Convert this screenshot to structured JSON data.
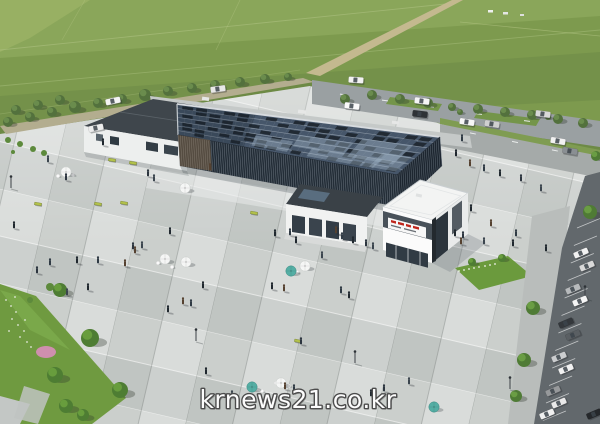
{
  "watermark": {
    "text": "krnews21.co.kr",
    "color": "#fcfcfc",
    "outline": "#4c4c4c"
  },
  "palette": {
    "field": "#7d9a4e",
    "fieldLight": "#8aa65a",
    "plaza": "#ced2d0",
    "plazaLight": "#d9dcda",
    "roofGlass": "#46566a",
    "roofPanelDark": "#1d242c",
    "roofReflection": "#a3b7c8",
    "latticeDark": "#232d37",
    "latticeLine": "#8e99a3",
    "buildingWhite": "#f1f2f1",
    "roadAsphalt": "#9aa0a2",
    "parkingAsphalt": "#62686c",
    "gardenGreen": "#6f9a40",
    "umbrellaTeal": "#54aea4",
    "umbrellaWhite": "#f5f6f5",
    "signRed": "#c0271d",
    "dirtRoad": "#c4b98f",
    "flowerPink": "#cf8fae",
    "lawnLetterWhite": "#f2f4ef",
    "person_colors": [
      "#2c353f",
      "#3b454e",
      "#1f272e",
      "#554130",
      "#2f3a44",
      "#20282f"
    ]
  },
  "figures": {
    "people": [
      [
        66,
        180
      ],
      [
        48,
        162
      ],
      [
        14,
        228
      ],
      [
        125,
        266
      ],
      [
        98,
        263
      ],
      [
        170,
        234
      ],
      [
        133,
        249
      ],
      [
        142,
        248
      ],
      [
        203,
        288
      ],
      [
        183,
        304
      ],
      [
        191,
        306
      ],
      [
        275,
        236
      ],
      [
        338,
        234
      ],
      [
        322,
        258
      ],
      [
        272,
        289
      ],
      [
        284,
        291
      ],
      [
        341,
        293
      ],
      [
        349,
        298
      ],
      [
        301,
        344
      ],
      [
        232,
        397
      ],
      [
        206,
        374
      ],
      [
        285,
        389
      ],
      [
        294,
        391
      ],
      [
        371,
        396
      ],
      [
        384,
        391
      ],
      [
        409,
        384
      ],
      [
        456,
        156
      ],
      [
        470,
        166
      ],
      [
        484,
        171
      ],
      [
        500,
        176
      ],
      [
        521,
        181
      ],
      [
        541,
        191
      ],
      [
        471,
        211
      ],
      [
        491,
        226
      ],
      [
        516,
        236
      ],
      [
        546,
        251
      ],
      [
        463,
        238
      ],
      [
        484,
        244
      ],
      [
        513,
        246
      ],
      [
        336,
        233
      ],
      [
        342,
        239
      ],
      [
        353,
        243
      ],
      [
        366,
        246
      ],
      [
        373,
        249
      ],
      [
        455,
        236
      ],
      [
        461,
        244
      ],
      [
        290,
        235
      ],
      [
        296,
        243
      ],
      [
        148,
        176
      ],
      [
        154,
        181
      ],
      [
        103,
        145
      ],
      [
        210,
        170
      ],
      [
        50,
        265
      ],
      [
        77,
        263
      ],
      [
        37,
        273
      ],
      [
        67,
        295
      ],
      [
        88,
        290
      ],
      [
        135,
        253
      ],
      [
        462,
        141
      ],
      [
        168,
        312
      ]
    ],
    "umbrellas": [
      [
        66,
        172,
        "w"
      ],
      [
        185,
        188,
        "w"
      ],
      [
        165,
        259,
        "w"
      ],
      [
        186,
        262,
        "w"
      ],
      [
        305,
        266,
        "w"
      ],
      [
        291,
        271,
        "t"
      ],
      [
        281,
        383,
        "w"
      ],
      [
        252,
        387,
        "t"
      ],
      [
        434,
        407,
        "t"
      ]
    ],
    "tables": [
      [
        58,
        176
      ],
      [
        73,
        175
      ],
      [
        158,
        263
      ],
      [
        172,
        267
      ],
      [
        297,
        272
      ],
      [
        276,
        383
      ],
      [
        289,
        386
      ],
      [
        262,
        391
      ]
    ],
    "benches": [
      [
        38,
        204,
        10
      ],
      [
        98,
        204,
        10
      ],
      [
        124,
        203,
        10
      ],
      [
        112,
        160,
        9
      ],
      [
        133,
        163,
        9
      ],
      [
        254,
        213,
        10
      ],
      [
        298,
        341,
        12
      ]
    ],
    "lamps": [
      [
        11,
        188
      ],
      [
        196,
        341
      ],
      [
        355,
        363
      ],
      [
        510,
        389
      ],
      [
        585,
        298
      ]
    ],
    "cars": [
      [
        113,
        101,
        -12,
        "#f4f4f4"
      ],
      [
        96,
        128,
        -12,
        "#ececec"
      ],
      [
        218,
        89,
        -8,
        "#e8e8e8"
      ],
      [
        356,
        80,
        4,
        "#f2f2f2"
      ],
      [
        352,
        106,
        7,
        "#fafafa"
      ],
      [
        422,
        101,
        7,
        "#f5f5f5"
      ],
      [
        420,
        114,
        7,
        "#2e3236"
      ],
      [
        543,
        114,
        8,
        "#d8d8d8"
      ],
      [
        467,
        122,
        9,
        "#f6f6f6"
      ],
      [
        492,
        124,
        9,
        "#cfcfcf"
      ],
      [
        558,
        141,
        10,
        "#f1f1f1"
      ],
      [
        570,
        151,
        10,
        "#8a8f93"
      ],
      [
        581,
        253,
        -23,
        "#f2f2f2"
      ],
      [
        587,
        266,
        -23,
        "#d9d9d9"
      ],
      [
        573,
        289,
        -23,
        "#b7babc"
      ],
      [
        580,
        301,
        -23,
        "#f5f5f5"
      ],
      [
        566,
        323,
        -23,
        "#34383c"
      ],
      [
        573,
        335,
        -23,
        "#5a5f63"
      ],
      [
        559,
        357,
        -23,
        "#cbcdcf"
      ],
      [
        566,
        369,
        -23,
        "#f1f1f1"
      ],
      [
        553,
        391,
        -23,
        "#97999b"
      ],
      [
        559,
        403,
        -23,
        "#e9e9e9"
      ],
      [
        594,
        414,
        -23,
        "#25282b"
      ],
      [
        547,
        414,
        -23,
        "#f0f0f0"
      ]
    ],
    "trees": {
      "roadside": [
        [
          8,
          122,
          5
        ],
        [
          30,
          117,
          5
        ],
        [
          52,
          112,
          5
        ],
        [
          75,
          107,
          6
        ],
        [
          98,
          103,
          5
        ],
        [
          122,
          99,
          5
        ],
        [
          145,
          95,
          6
        ],
        [
          168,
          91,
          5
        ],
        [
          192,
          88,
          5
        ],
        [
          215,
          85,
          5
        ],
        [
          240,
          82,
          5
        ],
        [
          265,
          79,
          5
        ],
        [
          288,
          77,
          4
        ],
        [
          16,
          110,
          5
        ],
        [
          38,
          105,
          5
        ],
        [
          60,
          100,
          5
        ],
        [
          345,
          99,
          5
        ],
        [
          372,
          95,
          5
        ],
        [
          400,
          99,
          5
        ],
        [
          428,
          103,
          5
        ],
        [
          452,
          107,
          4
        ],
        [
          478,
          109,
          5
        ],
        [
          505,
          112,
          5
        ],
        [
          532,
          115,
          5
        ],
        [
          558,
          119,
          5
        ],
        [
          583,
          123,
          5
        ],
        [
          460,
          112,
          3
        ],
        [
          548,
          117,
          3
        ]
      ],
      "park": [
        [
          596,
          156,
          5
        ],
        [
          590,
          212,
          7
        ],
        [
          533,
          308,
          7
        ],
        [
          524,
          360,
          7
        ],
        [
          516,
          396,
          6
        ]
      ],
      "garden": [
        [
          90,
          338,
          9
        ],
        [
          60,
          290,
          7
        ],
        [
          55,
          375,
          8
        ],
        [
          66,
          406,
          7
        ],
        [
          83,
          415,
          6
        ],
        [
          120,
          390,
          8
        ],
        [
          472,
          262,
          4
        ],
        [
          502,
          258,
          4
        ]
      ],
      "bushes": [
        [
          8,
          140,
          3
        ],
        [
          20,
          144,
          3
        ],
        [
          33,
          149,
          3
        ],
        [
          13,
          152,
          2
        ],
        [
          44,
          153,
          3
        ],
        [
          50,
          287,
          4
        ],
        [
          30,
          300,
          3
        ]
      ]
    },
    "flowers_white": [
      [
        6,
        300
      ],
      [
        11,
        306
      ],
      [
        16,
        312
      ],
      [
        12,
        319
      ],
      [
        18,
        325
      ],
      [
        24,
        331
      ],
      [
        20,
        337
      ],
      [
        27,
        342
      ],
      [
        9,
        331
      ],
      [
        15,
        297
      ],
      [
        31,
        347
      ],
      [
        25,
        320
      ]
    ],
    "lawn_letters": [
      [
        459,
        271
      ],
      [
        464,
        270
      ],
      [
        469,
        269
      ],
      [
        474,
        268
      ],
      [
        479,
        267
      ],
      [
        485,
        266
      ],
      [
        490,
        265
      ],
      [
        495,
        264
      ]
    ]
  }
}
